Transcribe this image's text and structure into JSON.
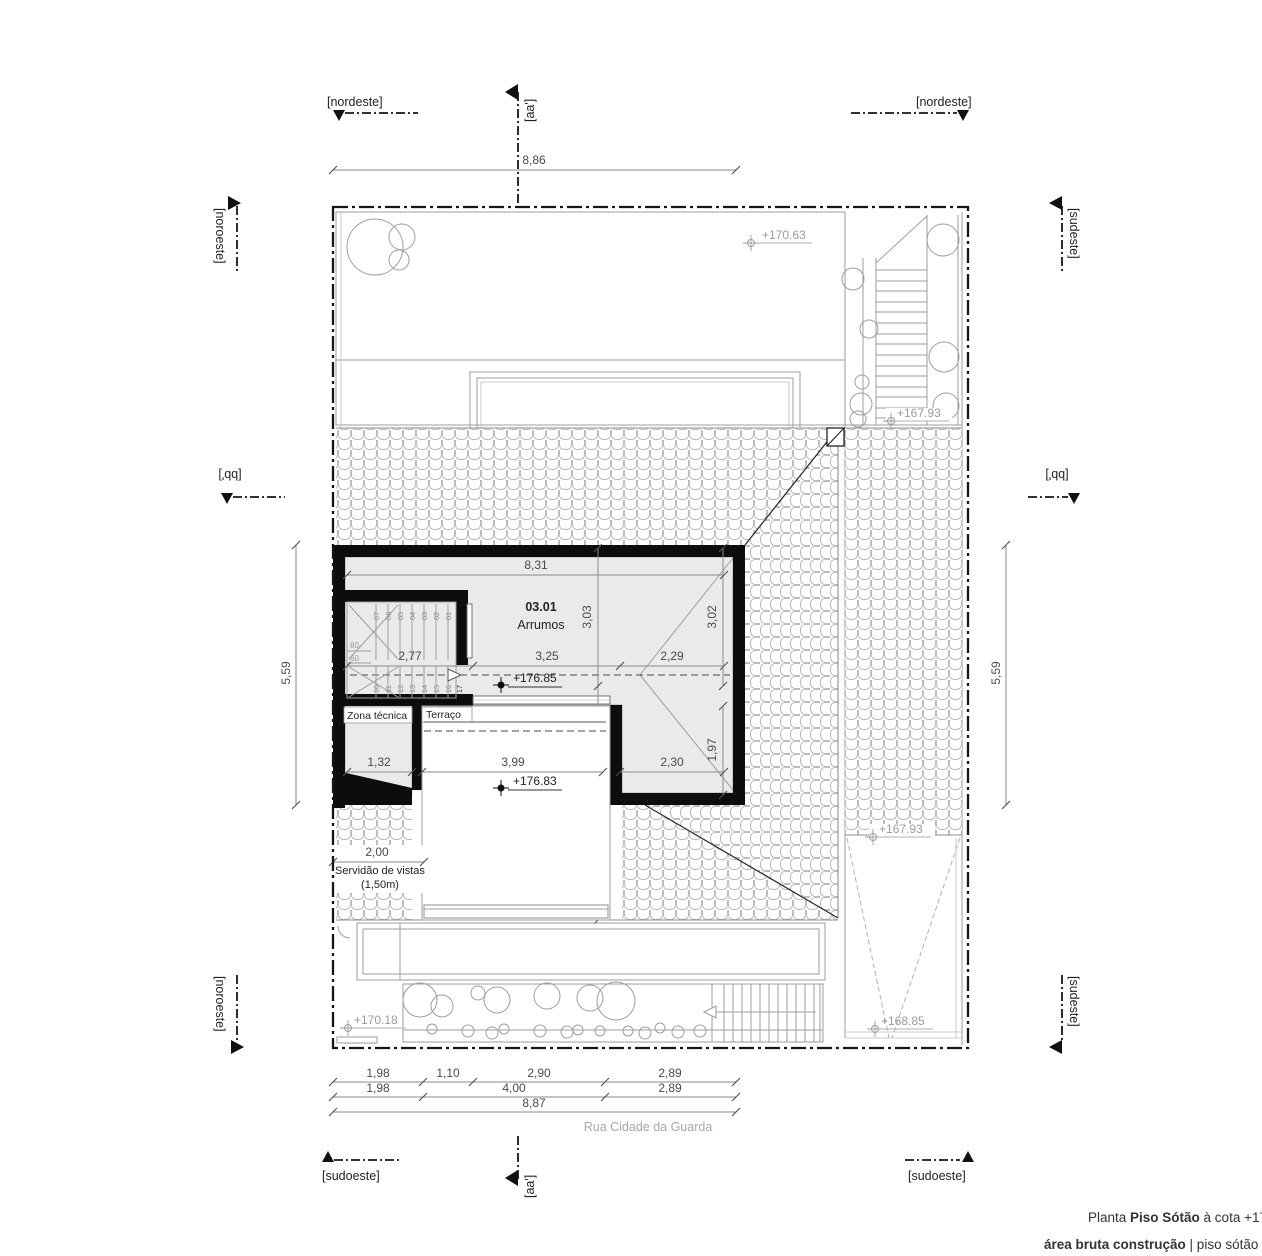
{
  "markers": {
    "nordeste": "[nordeste]",
    "noroeste": "[noroeste]",
    "sudeste": "[sudeste]",
    "sudoeste": "[sudoeste]",
    "aa": "[aa']",
    "bb": "[bb']"
  },
  "street": "Rua Cidade da Guarda",
  "rooms": {
    "number": "03.01",
    "name": "Arrumos",
    "zona_tecnica": "Zona técnica",
    "terraco": "Terraço",
    "servidao_line1": "Servidão de vistas",
    "servidao_line2": "(1,50m)"
  },
  "levels": {
    "l17063": "+170.63",
    "l16793": "+167.93",
    "l17685": "+176.85",
    "l17683": "+176.83",
    "l16885": "+168.85",
    "l17018": "+170.18"
  },
  "dimensions": {
    "top": "8,86",
    "side": "5,59",
    "room_width": "8,31",
    "d277": "2,77",
    "d325": "3,25",
    "d229": "2,29",
    "d303": "3,03",
    "d302": "3,02",
    "d197": "1,97",
    "d435": "4,35",
    "d132": "1,32",
    "d399": "3,99",
    "d230": "2,30",
    "d200": "2,00",
    "b198": "1,98",
    "b110": "1,10",
    "b290": "2,90",
    "b289": "2,89",
    "b400": "4,00",
    "b887": "8,87"
  },
  "stair": {
    "upper": [
      "07",
      "06",
      "05",
      "04",
      "03",
      "02",
      "01"
    ],
    "lower": [
      "10",
      "11",
      "12",
      "13",
      "14",
      "15",
      "16",
      "17"
    ],
    "r80": "80",
    "r60": "60"
  },
  "title_block": {
    "p1": "Planta ",
    "p2": "Piso Sótão",
    "p3": " à cota +178",
    "p4": "área bruta construção",
    "p5": " | piso sótão = 031"
  }
}
